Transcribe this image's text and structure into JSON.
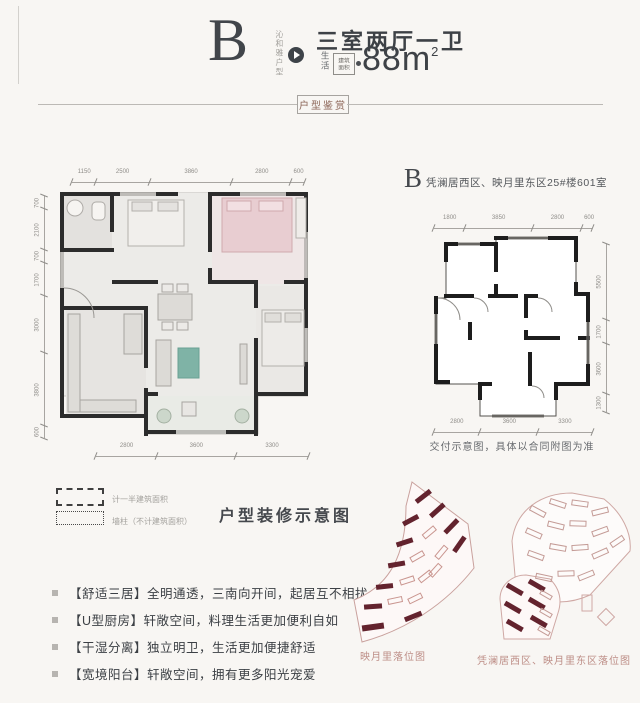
{
  "header": {
    "letter": "B",
    "vertical_tagline": "沁和雅户型",
    "room_title": "三室两厅一卫",
    "life_label": "生活",
    "area_label_line1": "建筑",
    "area_label_line2": "面积",
    "area_value": "88m",
    "area_superscript": "2"
  },
  "divider": {
    "label": "户型鉴赏"
  },
  "left_plan": {
    "dims_top": [
      "1150",
      "2500",
      "3860",
      "2800",
      "600"
    ],
    "dims_left": [
      "700",
      "2100",
      "700",
      "1700",
      "3000",
      "3800",
      "600"
    ],
    "dims_bottom": [
      "2800",
      "3600",
      "3300"
    ]
  },
  "right_plan": {
    "letter": "B",
    "title": "凭澜居西区、映月里东区25#楼601室",
    "dims_top": [
      "1800",
      "3850",
      "2800",
      "600"
    ],
    "dims_right": [
      "5500",
      "1700",
      "3600",
      "1300"
    ],
    "dims_bottom": [
      "2800",
      "3600",
      "3300"
    ],
    "caption": "交付示意图，具体以合同附图为准"
  },
  "legend": {
    "half_area": "计一半建筑面积",
    "wall_column": "墙柱（不计建筑面积）"
  },
  "section_title": "户型装修示意图",
  "features": [
    "【舒适三居】全明通透，三南向开间，起居互不相扰",
    "【U型厨房】轩敞空间，料理生活更加便利自如",
    "【干湿分离】独立明卫，生活更加便捷舒适",
    "【宽境阳台】轩敞空间，拥有更多阳光宠爱"
  ],
  "site_plans": {
    "left_caption": "映月里落位图",
    "right_caption": "凭澜居西区、映月里东区落位图"
  },
  "colors": {
    "accent_dark_red": "#63232e",
    "outline_pink": "#c99d98",
    "caption_red": "#bd8d86",
    "wall": "#2c2c2c",
    "teal": "#7fb3a6",
    "bed_pink": "#e8cdd1"
  }
}
